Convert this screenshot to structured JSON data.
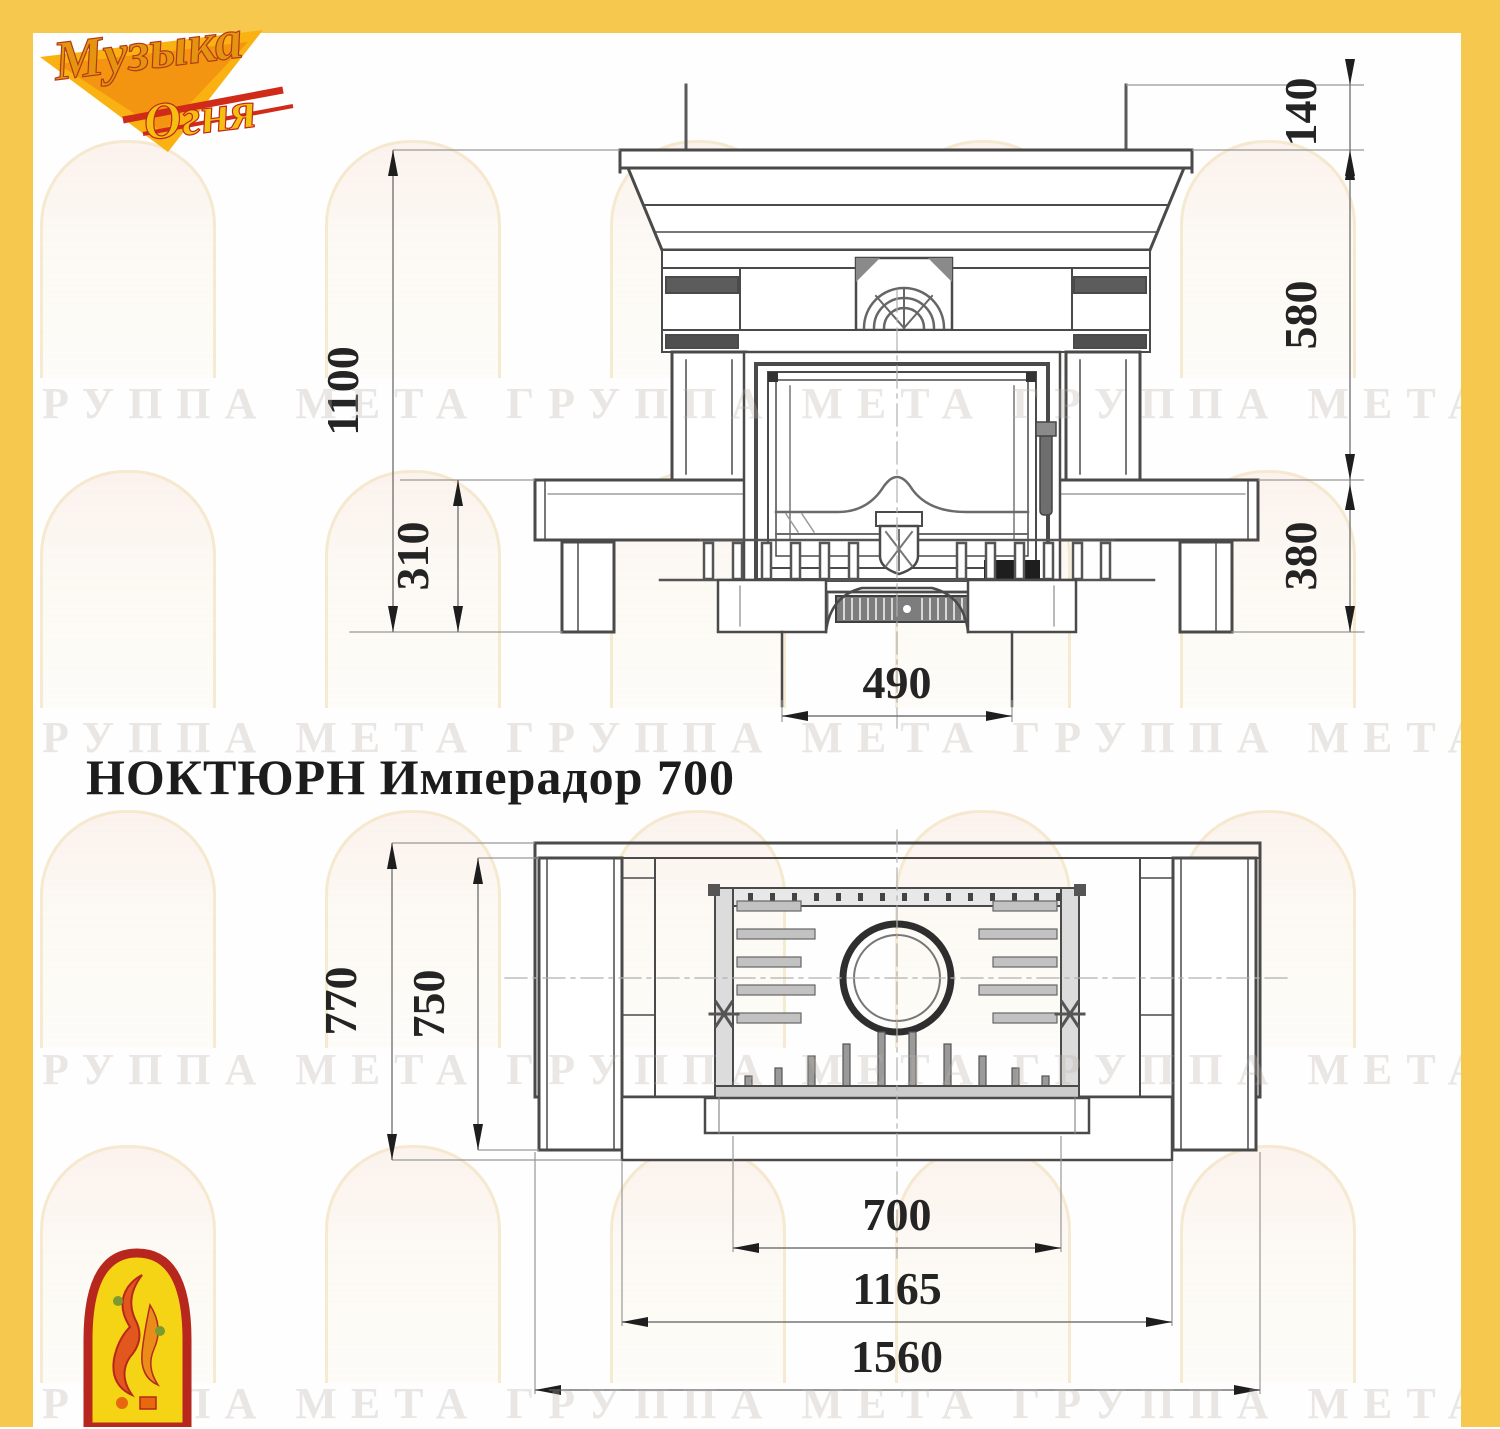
{
  "page": {
    "title": "НОКТЮРН Имперадор 700"
  },
  "logo": {
    "line1": "Музыка",
    "line2": "Огня"
  },
  "watermark": {
    "text": "ГРУППА МЕТА"
  },
  "colors": {
    "frame_yellow": "#f6c84d",
    "logo_red": "#c3271b",
    "logo_orange": "#e8920f",
    "logo_yellow": "#f5d416",
    "line_dark": "#4a4a4a",
    "line_thin": "#989898"
  },
  "front_view": {
    "dims": {
      "total_height": "1100",
      "base_height": "310",
      "pedestal_width": "490",
      "flue_height": "140",
      "middle_height": "580",
      "lower_height": "380"
    }
  },
  "plan_view": {
    "dims": {
      "depth_total": "770",
      "depth_inner": "750",
      "opening_width": "700",
      "front_width": "1165",
      "total_width": "1560"
    }
  }
}
